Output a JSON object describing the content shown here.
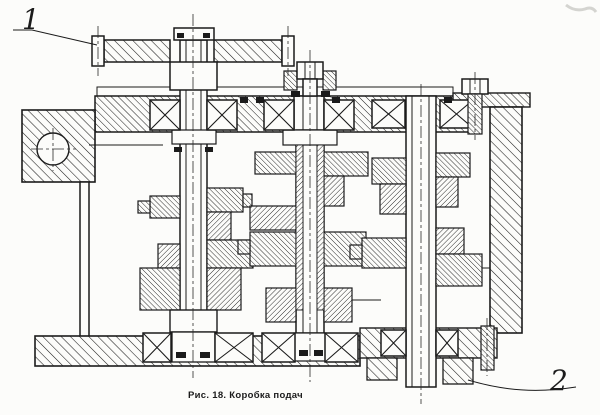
{
  "figure": {
    "caption": "Рис. 18. Коробка подач",
    "callouts": {
      "lever": "1",
      "output": "2"
    }
  },
  "colors": {
    "ink": "#1b1b1b",
    "paper": "#fcfcfa",
    "smudge": "#c9c9c6"
  }
}
